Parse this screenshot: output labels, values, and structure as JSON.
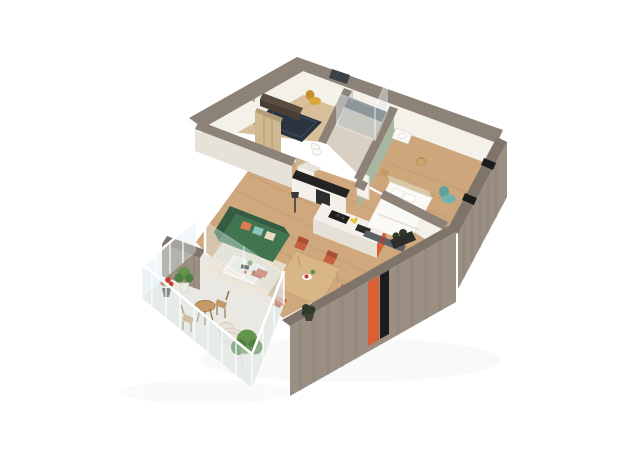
{
  "meta": {
    "type": "isometric-3d-floor-plan-render",
    "background": "#ffffff"
  },
  "rooms": [
    {
      "name": "entry-hall",
      "floor": "light-wood",
      "items": [
        "navy-rug",
        "dark-sideboard",
        "yellow-armchair",
        "wall-frame",
        "wardrobe"
      ]
    },
    {
      "name": "shower-room",
      "floor": "beige-tile",
      "items": [
        "glass-shower",
        "washbasin",
        "toilet"
      ]
    },
    {
      "name": "bedroom",
      "floor": "wood",
      "items": [
        "double-bed",
        "headboard",
        "foot-bench",
        "teal-armchair",
        "wicker-basket",
        "nightstand",
        "green-accent-wall"
      ]
    },
    {
      "name": "kitchen",
      "floor": "wood",
      "items": [
        "island-with-cooktop-and-sink",
        "orange-end-panel",
        "counter",
        "tall-cabinet",
        "lemons"
      ]
    },
    {
      "name": "living-room",
      "floor": "wood",
      "items": [
        "green-sofa",
        "cushions",
        "white-coffee-table",
        "light-rug",
        "floor-lamp"
      ]
    },
    {
      "name": "dining-area",
      "floor": "wood",
      "items": [
        "wood-dining-table",
        "six-terracotta-chairs",
        "centerpiece"
      ]
    },
    {
      "name": "balcony",
      "floor": "light-concrete",
      "items": [
        "glass-railing",
        "bistro-table",
        "two-folding-chairs",
        "potted-plants",
        "lounge-chair",
        "large-plant"
      ]
    }
  ],
  "colors": {
    "pageBg": "#ffffff",
    "wallTop": "#8d8277",
    "wallTopDark": "#7f746a",
    "facadeWood": "#9a8f82",
    "facadeStreak": "#6f655b",
    "interiorWhite": "#f4f1ea",
    "interiorShadow": "#e7e2d9",
    "floorMain": "#cfa87e",
    "floorEntry": "#d8bf9a",
    "floorBath": "#d9cfc2",
    "floorBedroom": "#cda67c",
    "plank": "#a9855c",
    "balconyFloor": "#eae8e2",
    "rugNavy": "#2a3340",
    "rugNavyLine": "#46556b",
    "rugLight": "#ece5d9",
    "sofaGreen": "#40754f",
    "sofaGreenDark": "#335c40",
    "pillowOrange": "#dd7c4e",
    "pillowTeal": "#8cc3bd",
    "pillowCream": "#e9dcc3",
    "tableWood": "#d9b688",
    "tableWoodEdge": "#c49f6e",
    "chairTerracotta": "#c75f3f",
    "chairTerracottaDark": "#a94e33",
    "islandWhite": "#f3f0ea",
    "islandEdge": "#e6e1d6",
    "counterBlack": "#232323",
    "accentOrange": "#d96035",
    "lemon": "#e4c13e",
    "bedWhite": "#fbfaf7",
    "bedEdge": "#e6e1d7",
    "headboard": "#d9c8a5",
    "benchGray": "#5b6065",
    "tealChair": "#6fb3ac",
    "tealChairDark": "#5fa29a",
    "greenWall": "#a8b7a0",
    "basket": "#c8a56d",
    "glass": "#dfeef1",
    "glassFrame": "#ffffff",
    "showerDark": "#4a5055",
    "trayBeige": "#b5aa9d",
    "doorDark": "#3c4145",
    "windowBlack": "#1b1c1e",
    "wardrobe": "#cfb790",
    "wardrobeSeam": "#b39d74",
    "yellowChair": "#d8a83d",
    "yellowChairDark": "#c3922c",
    "sideboard": "#5a4c40",
    "sideboardFace": "#4a3e34",
    "woodFurn": "#c59a66",
    "woodFurnDark": "#8a6b45",
    "plantGreen": "#64944d",
    "plantDark": "#4f7f3f",
    "plantDarker": "#2f3b26",
    "potWhite": "#efece6",
    "potDark": "#434239",
    "flowerRed": "#c0392b",
    "loungeWhite": "#e9e4da",
    "loungeEdge": "#d2ccc0",
    "toiletWhite": "#fafaf8",
    "shadow": "#d8d4cc"
  }
}
